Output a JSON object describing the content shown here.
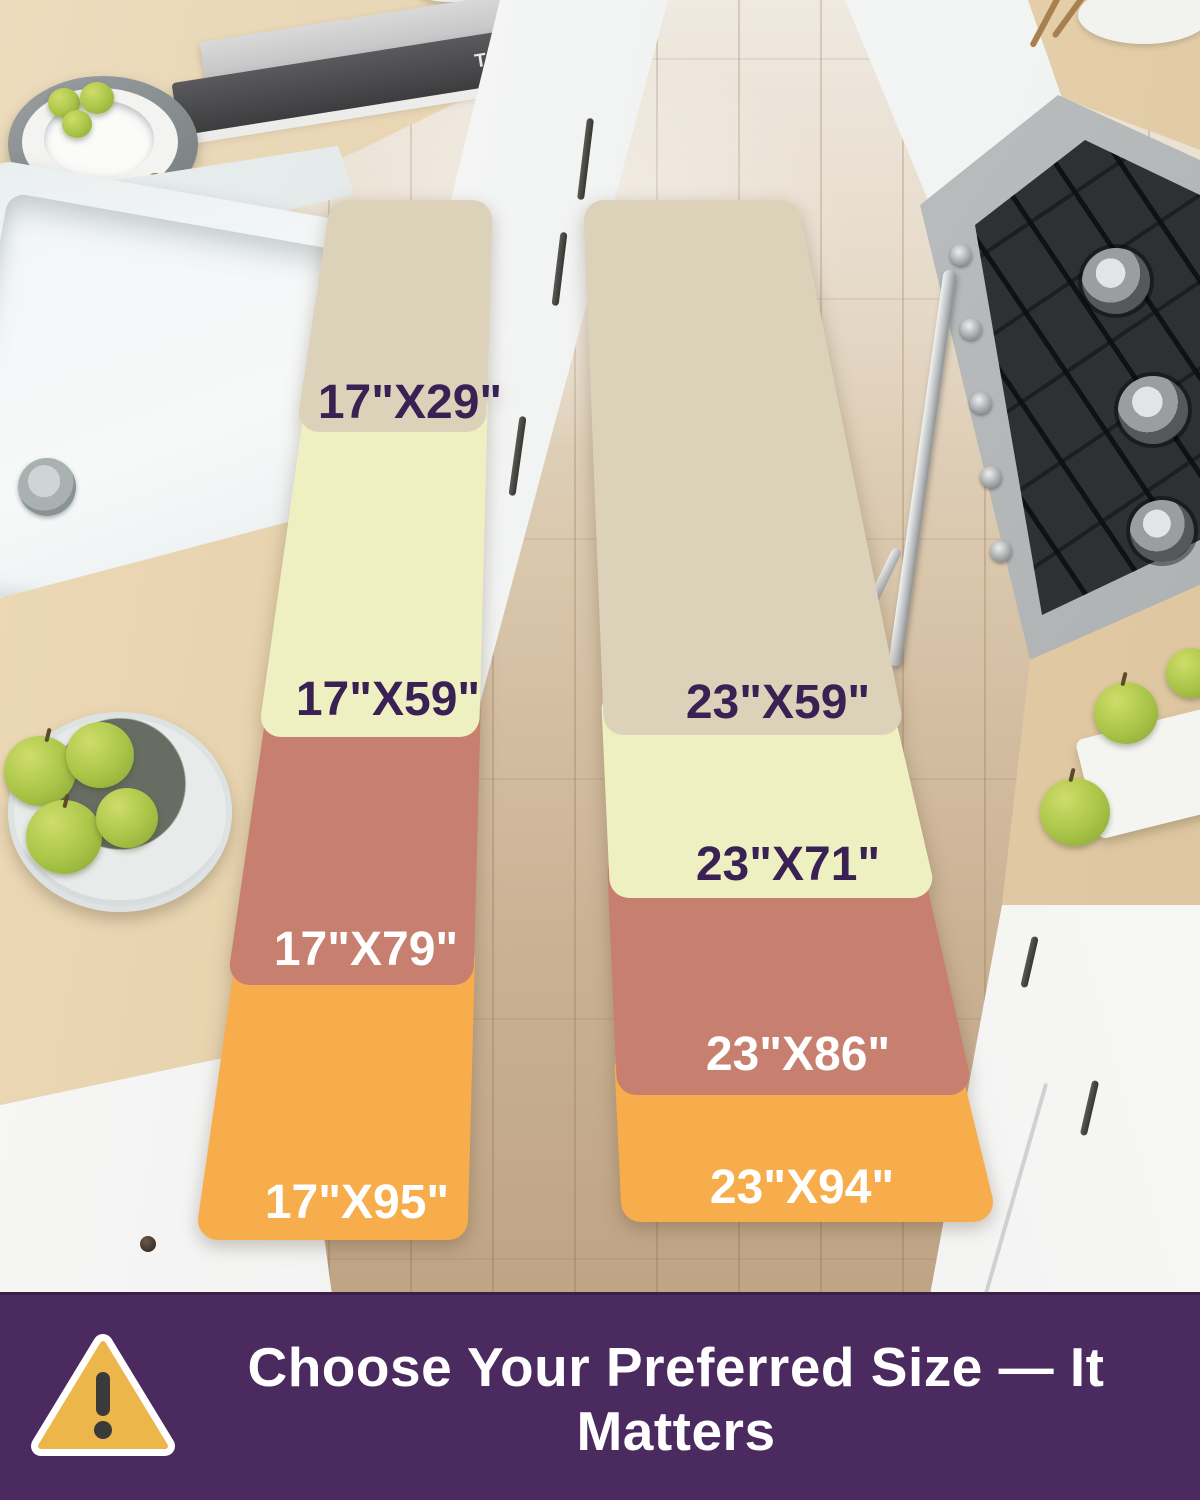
{
  "scene": {
    "book_title": "MAKING IT"
  },
  "mats": {
    "left": {
      "sizes": [
        {
          "label": "17\"X29\"",
          "color": "#DCD2B9",
          "label_color": "#3A2154"
        },
        {
          "label": "17\"X59\"",
          "color": "#EFF0C2",
          "label_color": "#3A2154"
        },
        {
          "label": "17\"X79\"",
          "color": "#C77F70",
          "label_color": "#FFFFFF"
        },
        {
          "label": "17\"X95\"",
          "color": "#F8AD4D",
          "label_color": "#FFFFFF"
        }
      ]
    },
    "right": {
      "sizes": [
        {
          "label": "23\"X59\"",
          "color": "#DCD2B9",
          "label_color": "#3A2154"
        },
        {
          "label": "23\"X71\"",
          "color": "#EFF0C2",
          "label_color": "#3A2154"
        },
        {
          "label": "23\"X86\"",
          "color": "#C77F70",
          "label_color": "#FFFFFF"
        },
        {
          "label": "23\"X94\"",
          "color": "#F8AD4D",
          "label_color": "#FFFFFF"
        }
      ]
    }
  },
  "banner": {
    "text": "Choose Your Preferred Size — It Matters",
    "background": "#4B2A5F",
    "text_color": "#FFFFFF",
    "warning_icon_color": "#ECB64A"
  }
}
